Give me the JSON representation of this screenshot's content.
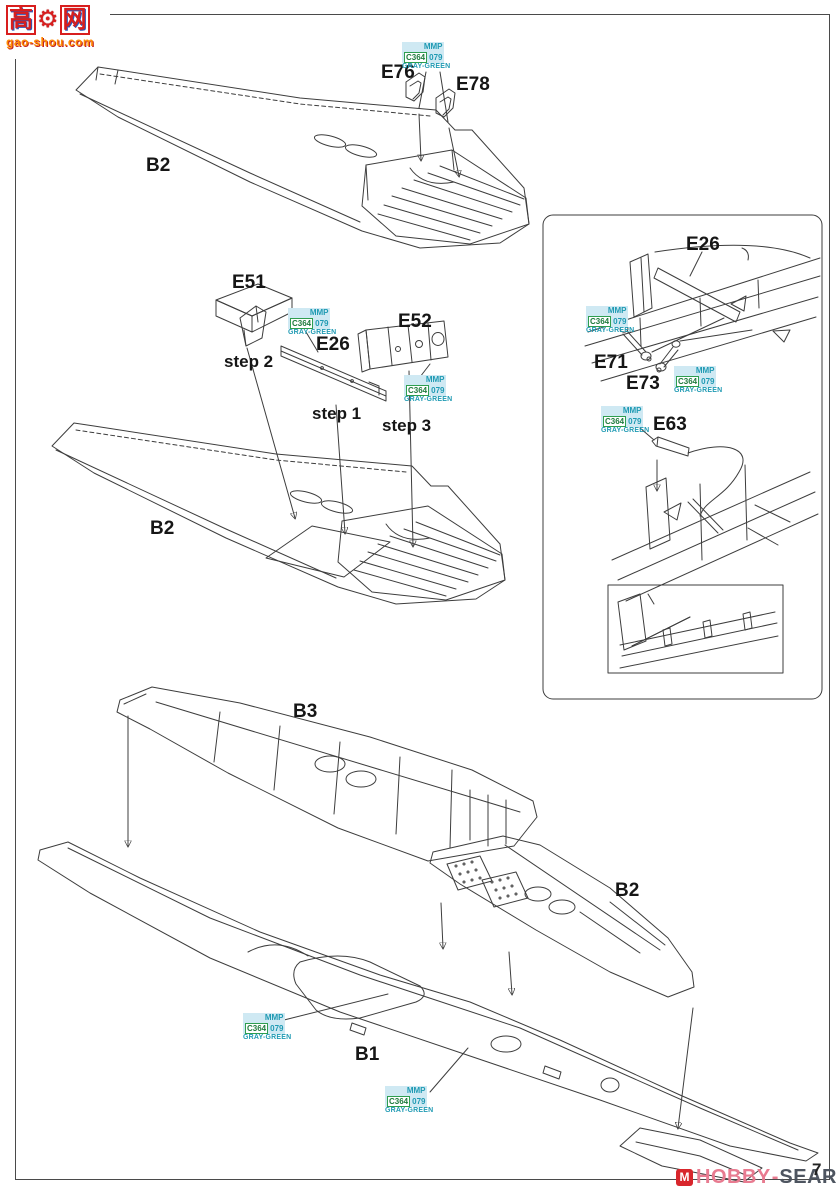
{
  "page": {
    "number": "7"
  },
  "watermark_top": {
    "char_left": "高",
    "char_right": "网",
    "url": "gao-shou.com"
  },
  "watermark_bottom": {
    "text1": "HOBBY",
    "text2": "SEARCH",
    "dash": "-"
  },
  "paint": {
    "brand": "MMP",
    "code1": "C364",
    "code2": "079",
    "name": "GRAY-GREEN"
  },
  "labels": {
    "d1_wing": "B2",
    "d1_part1": "E76",
    "d1_part2": "E78",
    "d2_bracket": "E51",
    "d2_strip": "E26",
    "d2_panel": "E52",
    "d2_step1": "step 1",
    "d2_step2": "step 2",
    "d2_step3": "step 3",
    "d2_wing": "B2",
    "panel_spar": "E26",
    "panel_lever1": "E71",
    "panel_lever2": "E73",
    "panel_cable": "E63",
    "d3_upper_wing": "B3",
    "d3_right_wing": "B2",
    "d3_lower_wing": "B1"
  }
}
